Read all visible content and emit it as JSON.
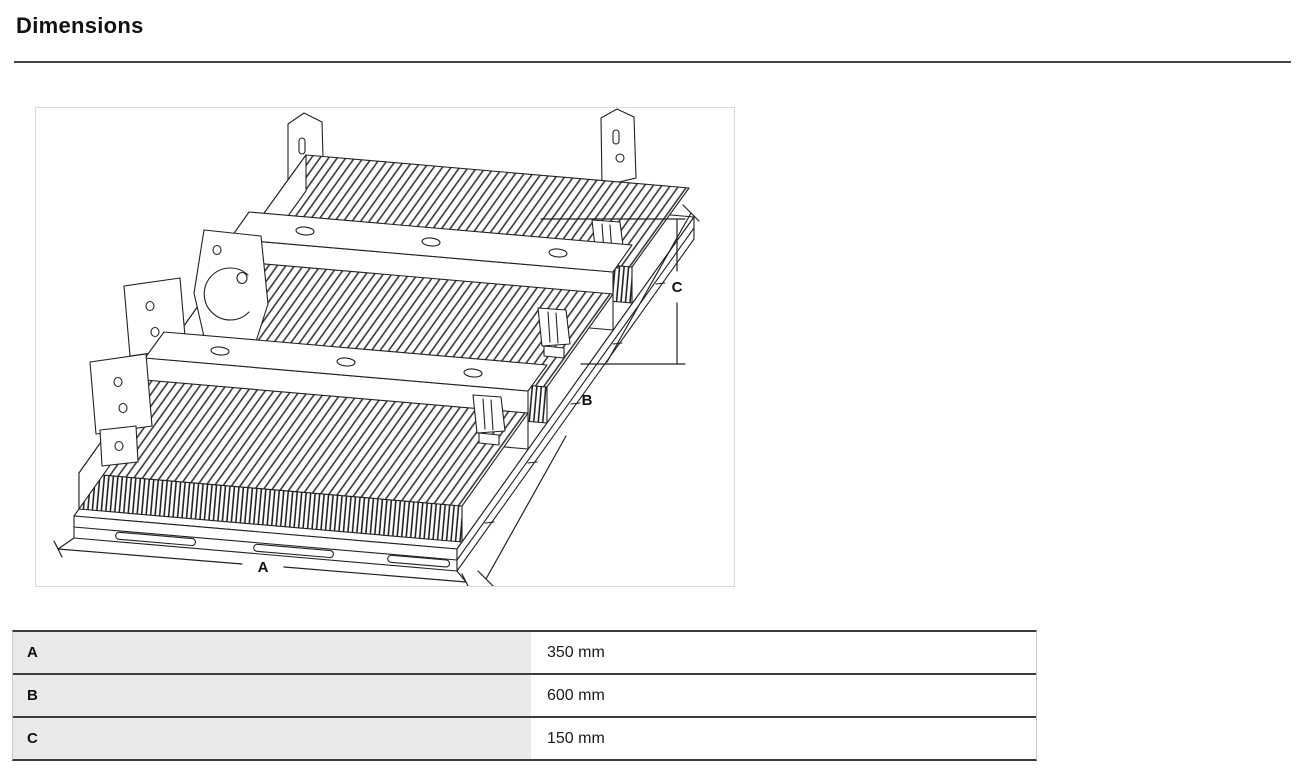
{
  "page": {
    "title": "Dimensions"
  },
  "figure": {
    "description": "isometric line drawing of LED floodlight heatsink module with mounting brackets",
    "labels": {
      "a": "A",
      "b": "B",
      "c": "C"
    }
  },
  "dimensions_table": {
    "rows": [
      {
        "label": "A",
        "value": "350 mm"
      },
      {
        "label": "B",
        "value": "600 mm"
      },
      {
        "label": "C",
        "value": "150 mm"
      }
    ]
  },
  "colors": {
    "heading_text": "#111111",
    "rule": "#464646",
    "figure_border": "#d9d9d9",
    "line_art": "#222222",
    "table_border_dark": "#3c3c3c",
    "table_border_light": "#c9c9c9",
    "label_cell_bg": "#eaeaea",
    "value_text": "#1a1a1a"
  }
}
